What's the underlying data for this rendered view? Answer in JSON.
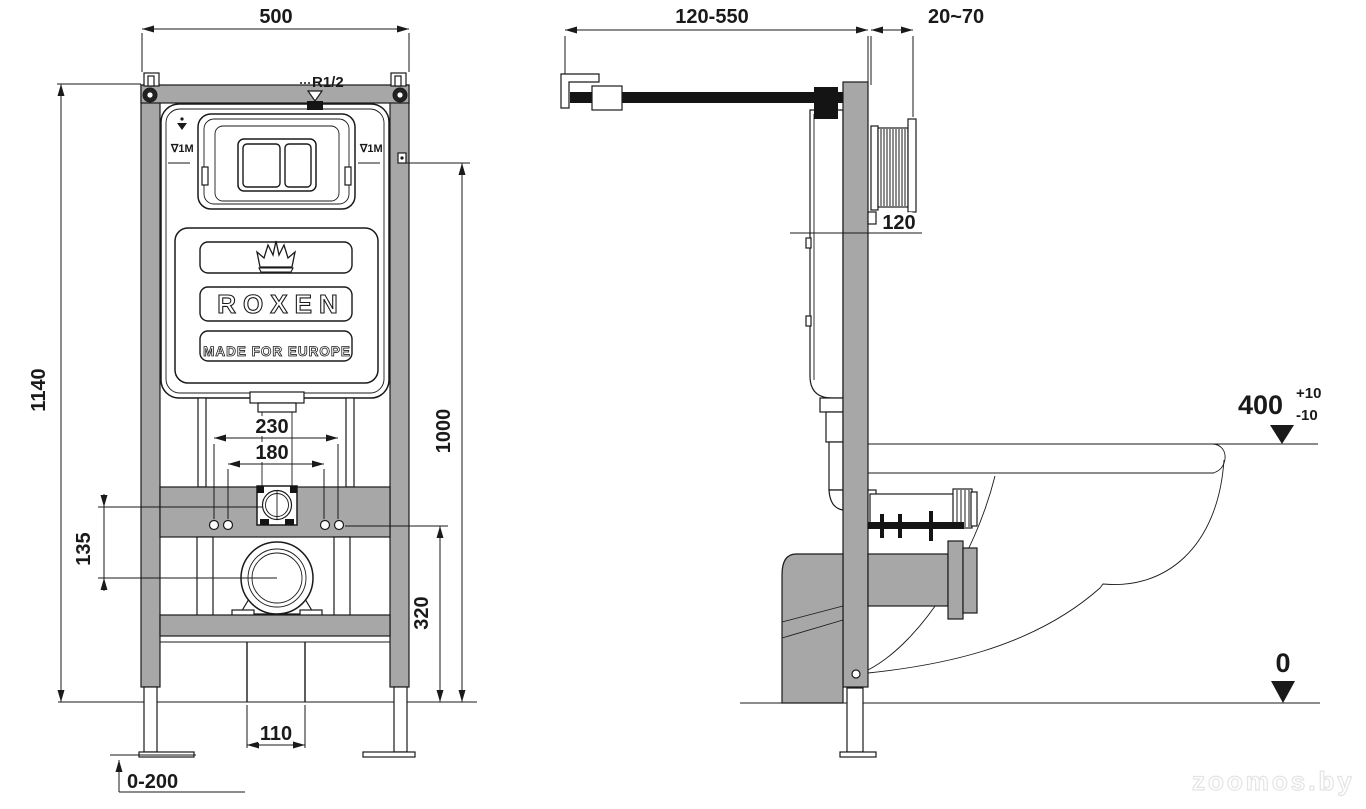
{
  "watermark": {
    "text": "zoomos.by"
  },
  "colors": {
    "frame_gray": "#a7a7a7",
    "line": "#1a1a1a",
    "background": "#ffffff",
    "pipe_black": "#141414"
  },
  "front": {
    "dim_500": "500",
    "dim_1140": "1140",
    "dim_1000": "1000",
    "dim_230": "230",
    "dim_180": "180",
    "dim_135": "135",
    "dim_320": "320",
    "dim_110": "110",
    "dim_leg": "0-200",
    "r12": "R1/2",
    "level_left": "∇1M",
    "level_right": "∇1M"
  },
  "brand": {
    "name": "ROXEN",
    "tagline": "MADE FOR EUROPE"
  },
  "side": {
    "dim_pipe": "120-550",
    "dim_wall": "20~70",
    "dim_depth": "120",
    "rim_value": "400",
    "rim_plus": "+10",
    "rim_minus": "-10",
    "floor_zero": "0"
  }
}
